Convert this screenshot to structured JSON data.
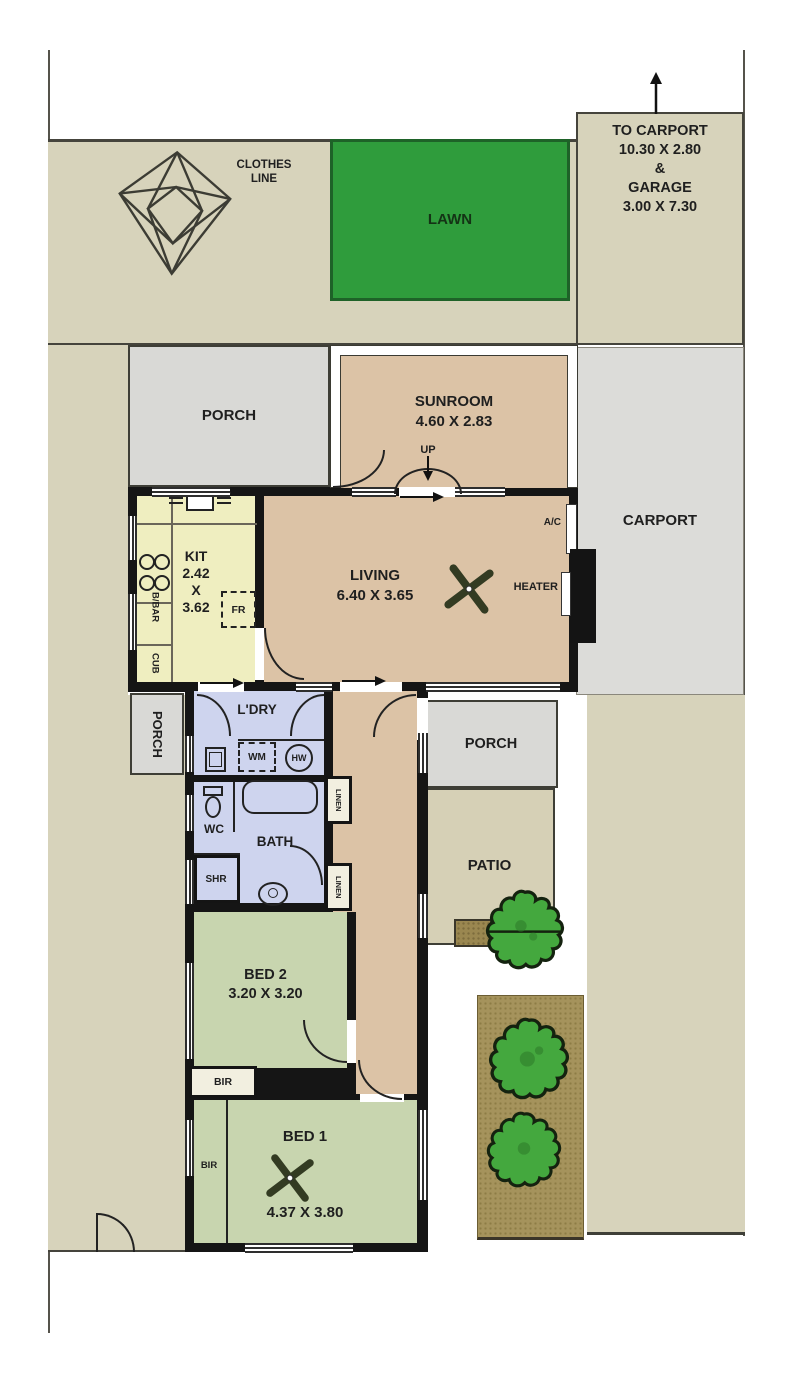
{
  "labels": {
    "clothes_line_1": "CLOTHES",
    "clothes_line_2": "LINE",
    "lawn": "LAWN",
    "to_carport": [
      "TO CARPORT",
      "10.30 X 2.80",
      "&",
      "GARAGE",
      "3.00 X 7.30"
    ],
    "porch_top": "PORCH",
    "porch_left": "PORCH",
    "porch_mid": "PORCH",
    "carport": "CARPORT",
    "patio": "PATIO",
    "sunroom_name": "SUNROOM",
    "sunroom_dims": "4.60 X 2.83",
    "up": "UP",
    "kit": [
      "KIT",
      "2.42",
      "X",
      "3.62"
    ],
    "bbar": "B/BAR",
    "cub": "CUB",
    "fr": "FR",
    "living_name": "LIVING",
    "living_dims": "6.40 X 3.65",
    "ac": "A/C",
    "heater": "HEATER",
    "ldry": "L'DRY",
    "wm": "WM",
    "hw": "HW",
    "wc": "WC",
    "bath": "BATH",
    "shr": "SHR",
    "linen": "LINEN",
    "bed2_name": "BED 2",
    "bed2_dims": "3.20 X 3.20",
    "bir": "BIR",
    "bed1_name": "BED 1",
    "bed1_dims": "4.37 X 3.80"
  },
  "colors": {
    "yard": "#d7d3bb",
    "lawn": "#2f9c3c",
    "room_tan": "#dcc3a6",
    "kitchen": "#efeec0",
    "wet_area": "#ced4ee",
    "bedroom": "#c8d5af",
    "porch": "#d9d9d6",
    "carport": "#dcdcd9",
    "patio": "#d6d0b6",
    "garden_bed": "#a5935c",
    "tree": "#44a83e",
    "wall": "#151515"
  }
}
